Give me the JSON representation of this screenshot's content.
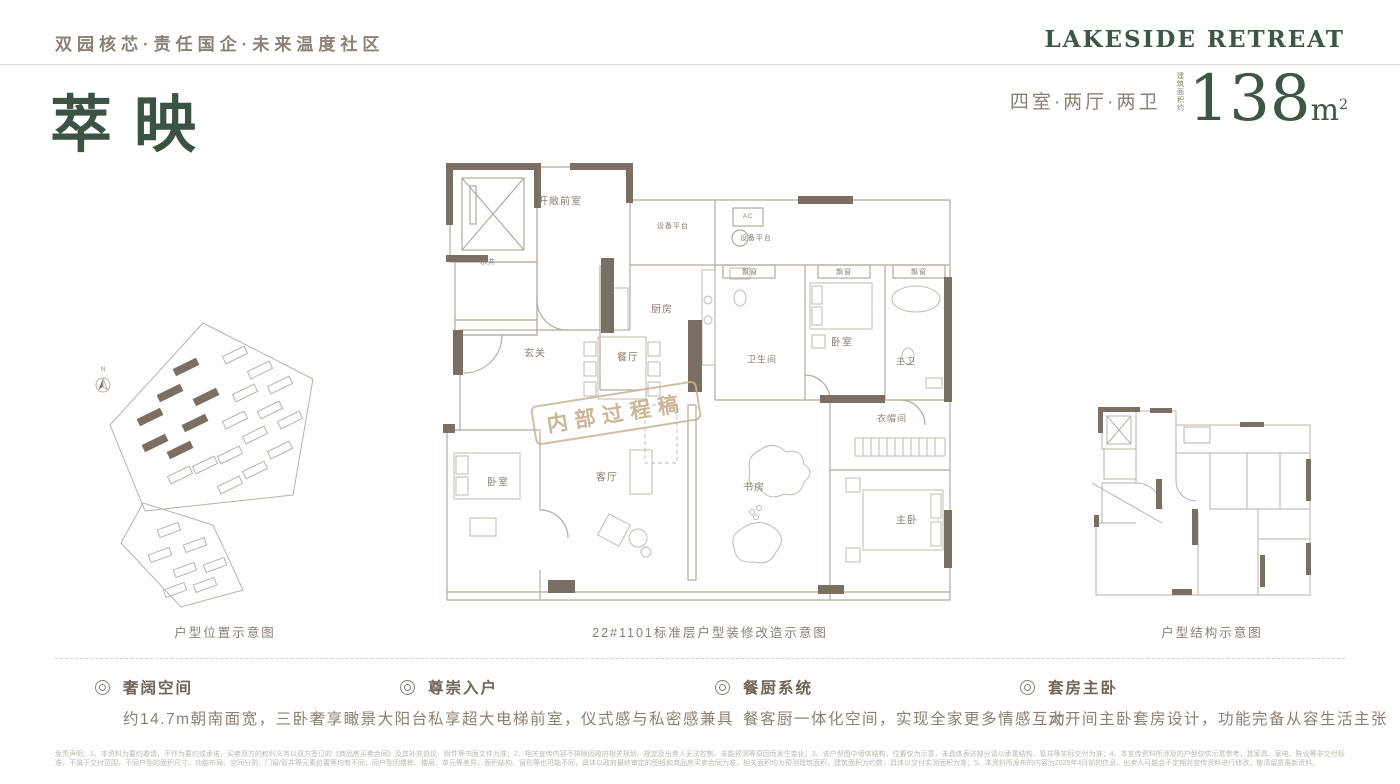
{
  "colors": {
    "accent_green": "#3d5745",
    "text_brown": "#8b8075",
    "wall_dark": "#7b6f63",
    "plan_line": "#b3aba2"
  },
  "header": {
    "tagline": "双园核芯·责任国企·未来温度社区",
    "brand": "LAKESIDE RETREAT"
  },
  "title": {
    "name": "萃映",
    "layout": "四室·两厅·两卫",
    "area_prefix": "建筑面积约",
    "area_value": "138",
    "area_unit": "m",
    "area_sup": "2"
  },
  "figures": {
    "north_label": "N",
    "site_plan_caption": "户型位置示意图",
    "floor_plan_caption": "22#1101标准层户型装修改造示意图",
    "structure_caption": "户型结构示意图",
    "watermark": "内部过程稿"
  },
  "floor_plan": {
    "rooms": [
      {
        "t": "开敞前室",
        "x": 120,
        "y": 50,
        "s": 10,
        "n": "front-room"
      },
      {
        "t": "水井",
        "x": 48,
        "y": 112,
        "s": 7,
        "n": "water-shaft"
      },
      {
        "t": "设备平台",
        "x": 233,
        "y": 76,
        "s": 7,
        "n": "equipment-platform-1"
      },
      {
        "t": "AC",
        "x": 308,
        "y": 67,
        "s": 6,
        "n": "ac"
      },
      {
        "t": "设备平台",
        "x": 316,
        "y": 88,
        "s": 7,
        "n": "equipment-platform-2"
      },
      {
        "t": "飘窗",
        "x": 310,
        "y": 122,
        "s": 7,
        "n": "bay-window-1"
      },
      {
        "t": "飘窗",
        "x": 404,
        "y": 122,
        "s": 7,
        "n": "bay-window-2"
      },
      {
        "t": "飘窗",
        "x": 479,
        "y": 122,
        "s": 7,
        "n": "bay-window-3"
      },
      {
        "t": "玄关",
        "x": 95,
        "y": 202,
        "s": 10,
        "n": "foyer"
      },
      {
        "t": "厨房",
        "x": 222,
        "y": 158,
        "s": 10,
        "n": "kitchen"
      },
      {
        "t": "餐厅",
        "x": 188,
        "y": 206,
        "s": 10,
        "n": "dining-room"
      },
      {
        "t": "卫生间",
        "x": 322,
        "y": 209,
        "s": 9,
        "n": "bathroom"
      },
      {
        "t": "卧室",
        "x": 402,
        "y": 191,
        "s": 10,
        "n": "bedroom-2"
      },
      {
        "t": "主卫",
        "x": 466,
        "y": 211,
        "s": 9,
        "n": "master-bath"
      },
      {
        "t": "衣帽间",
        "x": 452,
        "y": 268,
        "s": 9,
        "n": "cloakroom"
      },
      {
        "t": "卧室",
        "x": 58,
        "y": 331,
        "s": 10,
        "n": "bedroom-1"
      },
      {
        "t": "客厅",
        "x": 167,
        "y": 326,
        "s": 10,
        "n": "living-room"
      },
      {
        "t": "书房",
        "x": 314,
        "y": 336,
        "s": 10,
        "n": "study"
      },
      {
        "t": "主卧",
        "x": 467,
        "y": 369,
        "s": 10,
        "n": "master-bedroom"
      }
    ]
  },
  "features": [
    {
      "title": "奢阔空间",
      "desc": "约14.7m朝南面宽，三卧奢享瞰景大阳台"
    },
    {
      "title": "尊崇入户",
      "desc": "私享超大电梯前室，仪式感与私密感兼具"
    },
    {
      "title": "餐厨系统",
      "desc": "餐客厨一体化空间，实现全家更多情感互动"
    },
    {
      "title": "套房主卧",
      "desc": "大开间主卧套房设计，功能完备从容生活主张"
    }
  ],
  "disclaimer": {
    "text": "免责声明：1、本资料为要约邀请，不作为要约或承诺，买卖双方的权利义务以双方签订的《商品房买卖合同》及其补充协议、附件等书面文件为准；2、相关宣传内容不排除因政府相关规划、规定及出卖人无法控制、未能预测等原因而发生变化；3、该户型图中墙体结构、位置仅为示意，未具体表达部分请以承重结构、管井等实际交付为准；4、本宣传资料所涉及的户型仅供示意参考，其家具、家电、陈设等非交付标准，不属于交付范围，不同户型的面积尺寸、功能布局、空间分割、门窗/管井等元素位置等均有不同；同户型因楼栋、楼层、单元等差异，面积结构、窗形等也可能不同，具体以政府最终审定的图纸和商品房买卖合同为准，相关面积均为预测建筑面积，建筑面积为约数，具体以交付实测面积为准；5、本资料所发布的内容为2025年4月前的信息，出卖人可能会不定期对宣传资料进行修改，敬请留意最新资料。"
  }
}
